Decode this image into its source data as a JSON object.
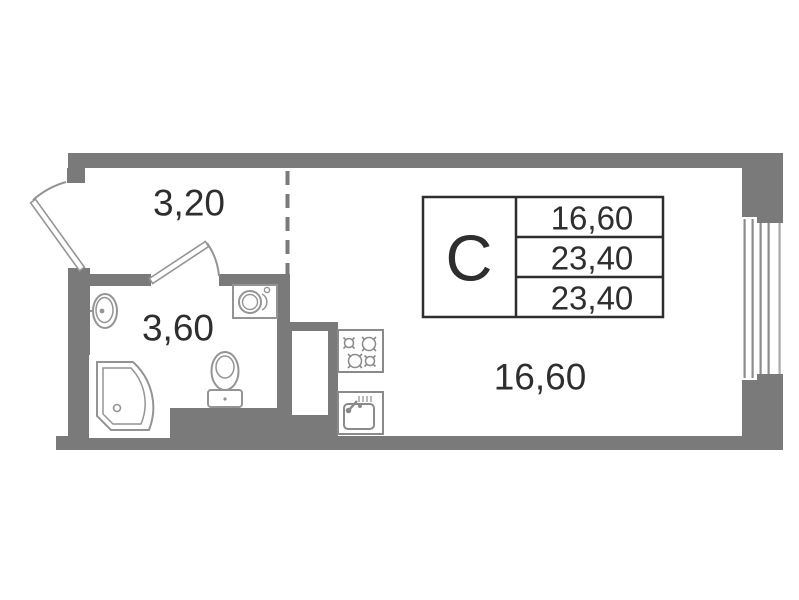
{
  "plan": {
    "title": "studio-apartment-floor-plan",
    "unit_letter": "С",
    "legend": {
      "rows": [
        "16,60",
        "23,40",
        "23,40"
      ]
    },
    "rooms": [
      {
        "name": "hallway",
        "area": "3,20"
      },
      {
        "name": "bathroom",
        "area": "3,60"
      },
      {
        "name": "living-room",
        "area": "16,60"
      }
    ],
    "fixtures": [
      "entrance-door",
      "bathroom-door",
      "wash-basin",
      "shower-cabin",
      "toilet",
      "washing-machine",
      "stove",
      "kitchen-sink",
      "ventilation-shaft",
      "window"
    ],
    "colors": {
      "wall": "#7a7a7a",
      "fixture": "#949494",
      "appliance": "#8a8a8a",
      "window_line": "#8c8c8c",
      "text": "#2e2e2e",
      "table_border": "#2e2e2e",
      "background": "#ffffff"
    }
  }
}
